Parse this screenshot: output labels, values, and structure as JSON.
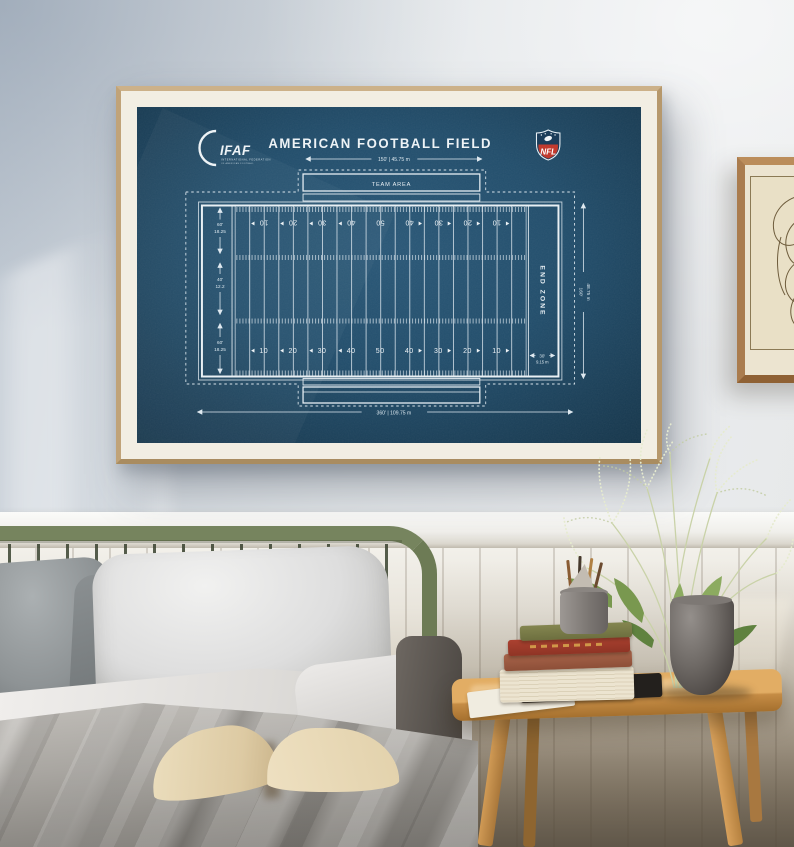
{
  "poster": {
    "title": "AMERICAN FOOTBALL FIELD",
    "ifaf_logo": {
      "text": "IFAF",
      "subtext_line1": "INTERNATIONAL FEDERATION",
      "subtext_line2": "OF AMERICAN FOOTBALL"
    },
    "nfl_logo": {
      "text": "NFL"
    },
    "team_area_label": "TEAM AREA",
    "end_zone_label": "END ZONE",
    "dimensions": {
      "top_width": "150' | 45.75 m",
      "bottom_length": "360' | 109.75 m",
      "right_height_ft": "160'",
      "right_height_m": "48.75 m",
      "side_top_ft": "60'",
      "side_top_m": "18.25",
      "side_middle_ft": "40'",
      "side_middle_m": "12.2",
      "side_bottom_ft": "60'",
      "side_bottom_m": "18.25",
      "end_zone_depth_ft": "30'",
      "end_zone_depth_m": "9.15 m"
    },
    "yard_numbers_top": [
      "10",
      "20",
      "30",
      "40",
      "50",
      "40",
      "30",
      "20",
      "10"
    ],
    "yard_numbers_bottom": [
      "10",
      "20",
      "30",
      "40",
      "50",
      "40",
      "30",
      "20",
      "10"
    ],
    "colors": {
      "blueprint_background": "#1e4560",
      "blueprint_line": "#e2ebf1",
      "frame_wood": "#c0a379",
      "mat": "#f2eee3",
      "nfl_red": "#c13a2e"
    }
  },
  "room": {
    "colors": {
      "wall": "#dfe3e7",
      "wainscot": "#ece9e1",
      "headboard_green": "#76845e",
      "table_wood": "#c8954f",
      "plant_pot": "#5c5755",
      "duvet": "#a3a09b"
    }
  }
}
